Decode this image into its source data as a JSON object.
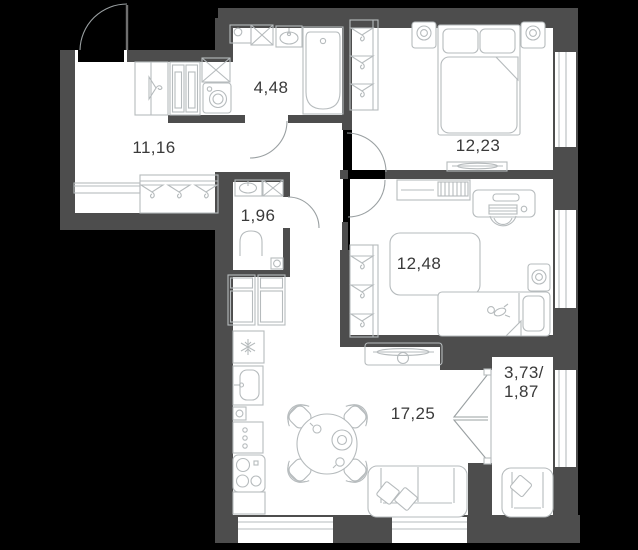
{
  "plan": {
    "type": "apartment-floor-plan",
    "units": "m2",
    "colors": {
      "background": "#000000",
      "wall": "#4d4d4d",
      "floor": "#ffffff",
      "furniture_line": "#b6bbbd",
      "door_line": "#9aa0a2",
      "text": "#3a3a3a"
    },
    "rooms": [
      {
        "id": "hallway",
        "area": "11,16",
        "fixtures": [
          "entrance-door",
          "sliding-closet",
          "cabinet",
          "vent-shaft",
          "washing-machine",
          "bench",
          "wardrobe-hangers"
        ]
      },
      {
        "id": "bathroom",
        "area": "4,48",
        "fixtures": [
          "cabinet",
          "vent-shaft",
          "sink",
          "bathtub",
          "door"
        ]
      },
      {
        "id": "bedroom",
        "area": "12,23",
        "fixtures": [
          "wardrobe-hangers",
          "nightstand-lamp",
          "double-bed",
          "nightstand-lamp",
          "tv-dresser",
          "window",
          "door"
        ]
      },
      {
        "id": "wc",
        "area": "1,96",
        "fixtures": [
          "sink",
          "vent-shaft",
          "toilet",
          "floor-drain",
          "door"
        ]
      },
      {
        "id": "kids-room",
        "area": "12,48",
        "fixtures": [
          "dresser",
          "desk",
          "chair",
          "rug",
          "wardrobe-hangers",
          "single-bed",
          "toy",
          "nightstand-lamp",
          "window",
          "door"
        ]
      },
      {
        "id": "living-kitchen",
        "area": "17,25",
        "fixtures": [
          "tall-cabinets",
          "fridge",
          "kitchen-sink",
          "drawers",
          "stove",
          "dining-table",
          "chairs",
          "tv-stand",
          "sofa",
          "pillows",
          "windows"
        ]
      },
      {
        "id": "balcony",
        "area_line1": "3,73/",
        "area_line2": "1,87",
        "fixtures": [
          "french-door",
          "armchair",
          "window"
        ]
      }
    ]
  }
}
